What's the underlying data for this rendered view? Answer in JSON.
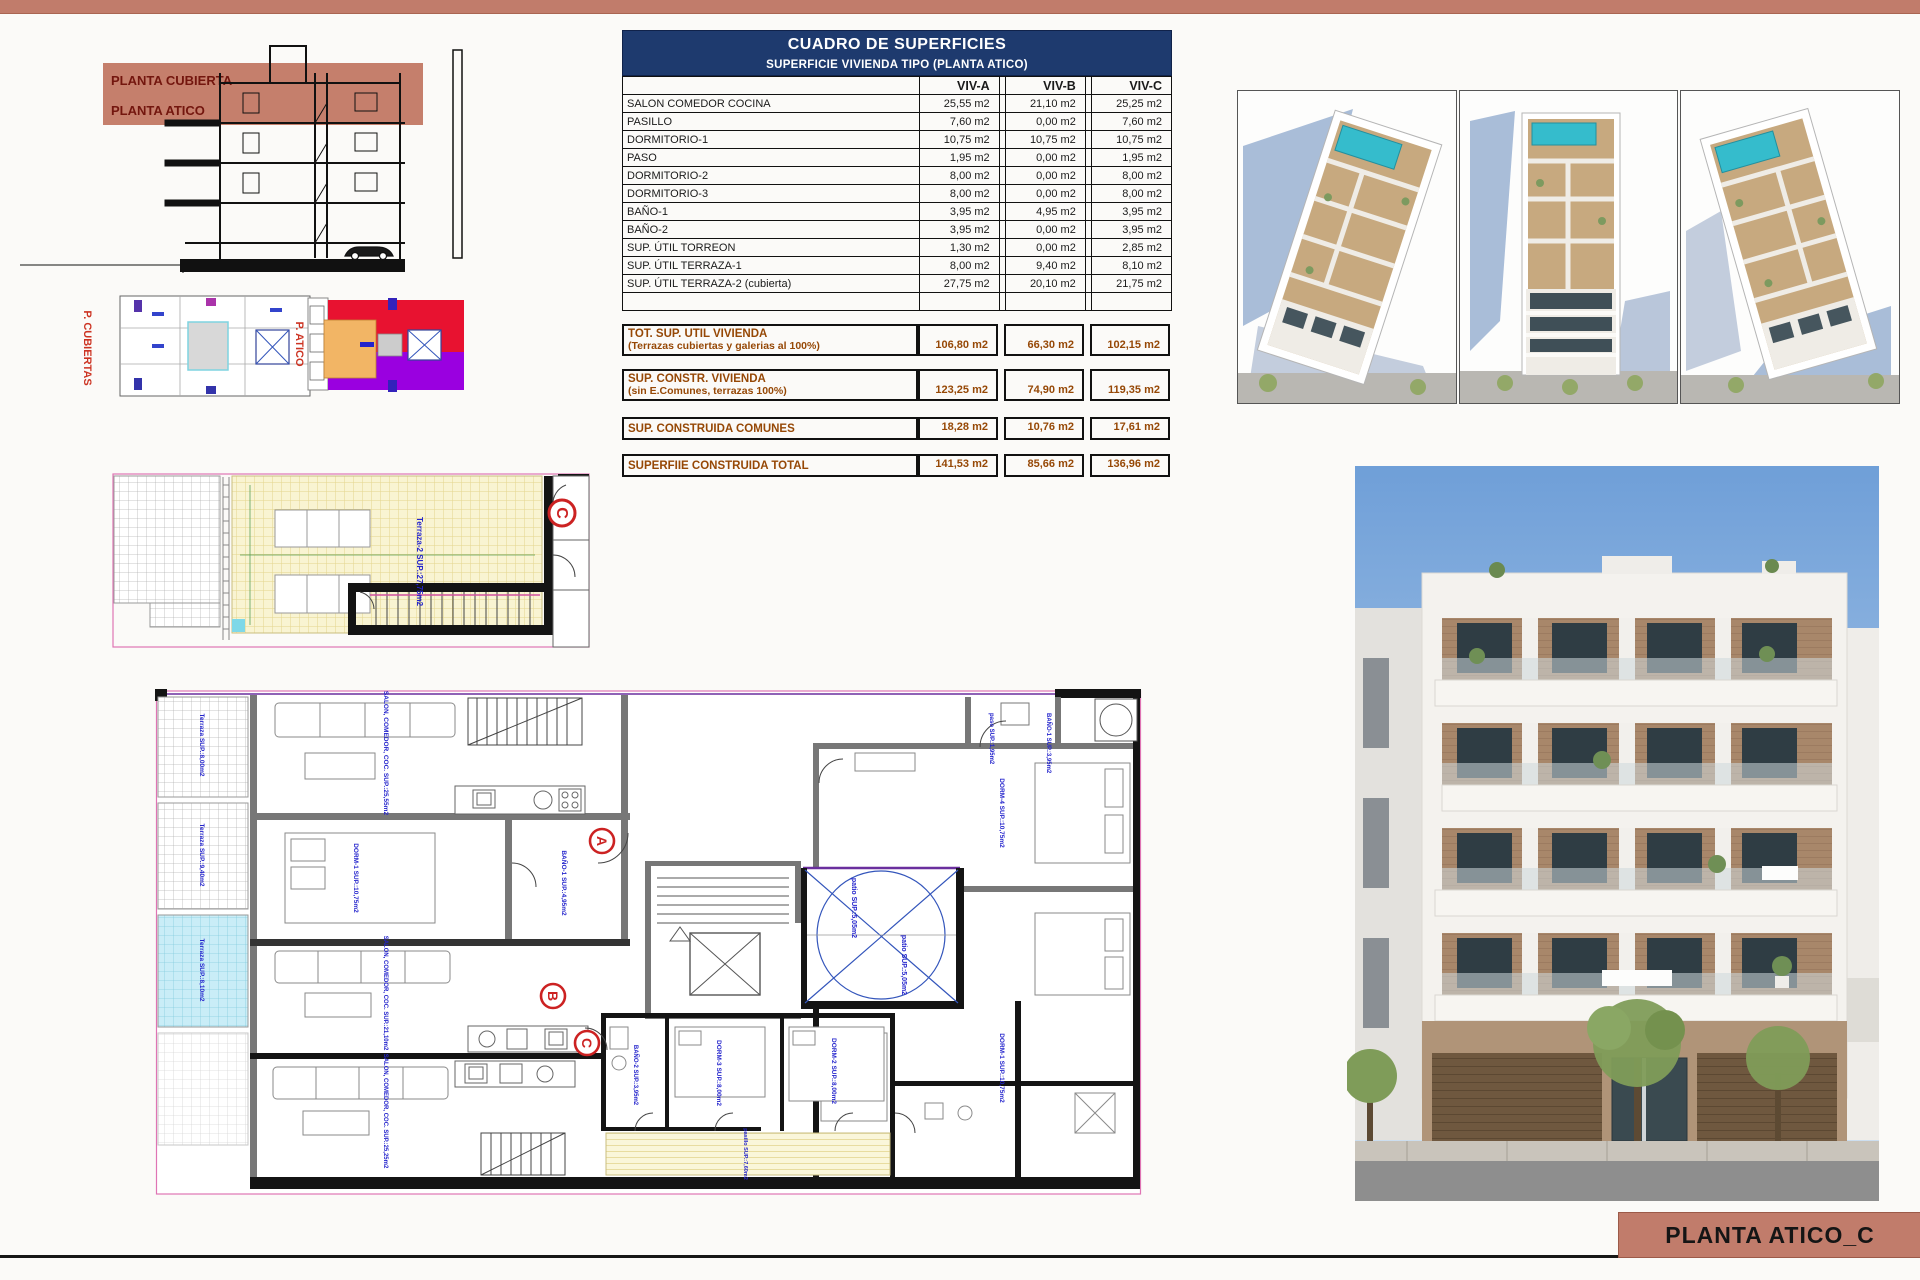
{
  "page": {
    "title_block_label": "PLANTA ATICO_C"
  },
  "colors": {
    "accent_salmon": "#c17c6b",
    "header_navy": "#1e3a6e",
    "totals_brown": "#964806",
    "plan_label_blue": "#2323cc",
    "marker_red": "#cc2222",
    "hatch_yellow": "#f9f4d2",
    "terrace_cyan": "#c9edf7",
    "pool_teal": "#35bccc",
    "keyplan_red": "#e81230",
    "keyplan_purple": "#9a00e0",
    "keyplan_orange": "#f2b565"
  },
  "section_drawing": {
    "band_labels": [
      "PLANTA CUBIERTA",
      "PLANTA ATICO"
    ]
  },
  "key_plans": {
    "left_label": "P. CUBIERTAS",
    "right_label": "P. ATICO"
  },
  "surface_table": {
    "title": "CUADRO DE SUPERFICIES",
    "subtitle": "SUPERFICIE VIVIENDA TIPO  (PLANTA ATICO)",
    "columns": [
      "VIV-A",
      "VIV-B",
      "VIV-C"
    ],
    "rows": [
      {
        "label": "SALON COMEDOR COCINA",
        "a": "25,55 m2",
        "b": "21,10 m2",
        "c": "25,25 m2"
      },
      {
        "label": "PASILLO",
        "a": "7,60 m2",
        "b": "0,00 m2",
        "c": "7,60 m2"
      },
      {
        "label": "DORMITORIO-1",
        "a": "10,75 m2",
        "b": "10,75 m2",
        "c": "10,75 m2"
      },
      {
        "label": "PASO",
        "a": "1,95 m2",
        "b": "0,00 m2",
        "c": "1,95 m2"
      },
      {
        "label": "DORMITORIO-2",
        "a": "8,00 m2",
        "b": "0,00 m2",
        "c": "8,00 m2"
      },
      {
        "label": "DORMITORIO-3",
        "a": "8,00 m2",
        "b": "0,00 m2",
        "c": "8,00 m2"
      },
      {
        "label": "BAÑO-1",
        "a": "3,95 m2",
        "b": "4,95 m2",
        "c": "3,95 m2"
      },
      {
        "label": "BAÑO-2",
        "a": "3,95 m2",
        "b": "0,00 m2",
        "c": "3,95 m2"
      },
      {
        "label": "SUP. ÚTIL TORREON",
        "a": "1,30 m2",
        "b": "0,00 m2",
        "c": "2,85 m2"
      },
      {
        "label": "SUP. ÚTIL TERRAZA-1",
        "a": "8,00 m2",
        "b": "9,40 m2",
        "c": "8,10 m2"
      },
      {
        "label": "SUP. ÚTIL TERRAZA-2 (cubierta)",
        "a": "27,75 m2",
        "b": "20,10 m2",
        "c": "21,75 m2"
      },
      {
        "label": "",
        "a": "",
        "b": "",
        "c": ""
      }
    ],
    "totals": [
      {
        "label": "TOT. SUP. UTIL VIVIENDA",
        "sublabel": "(Terrazas cubiertas y galerias al 100%)",
        "a": "106,80 m2",
        "b": "66,30 m2",
        "c": "102,15 m2"
      },
      {
        "label": "SUP. CONSTR. VIVIENDA",
        "sublabel": "(sin E.Comunes, terrazas 100%)",
        "a": "123,25 m2",
        "b": "74,90 m2",
        "c": "119,35 m2"
      },
      {
        "label": "SUP. CONSTRUIDA COMUNES",
        "sublabel": "",
        "a": "18,28 m2",
        "b": "10,76 m2",
        "c": "17,61 m2"
      },
      {
        "label": "SUPERFIIE CONSTRUIDA TOTAL",
        "sublabel": "",
        "a": "141,53 m2",
        "b": "85,66 m2",
        "c": "136,96 m2"
      }
    ]
  },
  "roof_plan": {
    "marker": "C",
    "terrace_label": "Terraza-2 SUP.:27,75m2"
  },
  "main_plan": {
    "markers": {
      "a": "A",
      "b": "B",
      "c": "C"
    },
    "labels": {
      "salon_a": "SALON, COMEDOR, COC. SUP.:25,55m2",
      "dorm1_a": "DORM-1 SUP.:10,75m2",
      "bano1_b": "BAÑO-1 SUP.:4,95m2",
      "salon_b": "SALON, COMEDOR, COC. SUP.:21,10m2",
      "salon_c": "SALON, COMEDOR, COC. SUP.:25,25m2",
      "patio_1": "patio SUP.:5,05m2",
      "patio_2": "patio SUP.:5,05m2",
      "paso_r": "paso SUP.:1,95m2",
      "bano1_r": "BAÑO-1 SUP.:3,95m2",
      "dorm4_r": "DORM-4 SUP.:10,75m2",
      "dorm1_r": "DORM-1 SUP.:10,75m2",
      "bano2_c": "BAÑO-2 SUP.:3,95m2",
      "dorm3_c": "DORM-3 SUP.:8,00m2",
      "dorm2_c": "DORM-2 SUP.:8,00m2",
      "pasillo": "pasillo SUP.:7,60m2",
      "terraza_a": "Terraza SUP.:8,00m2",
      "terraza_b": "Terraza SUP.:9,40m2",
      "terraza_c": "Terraza SUP.:8,10m2"
    }
  }
}
